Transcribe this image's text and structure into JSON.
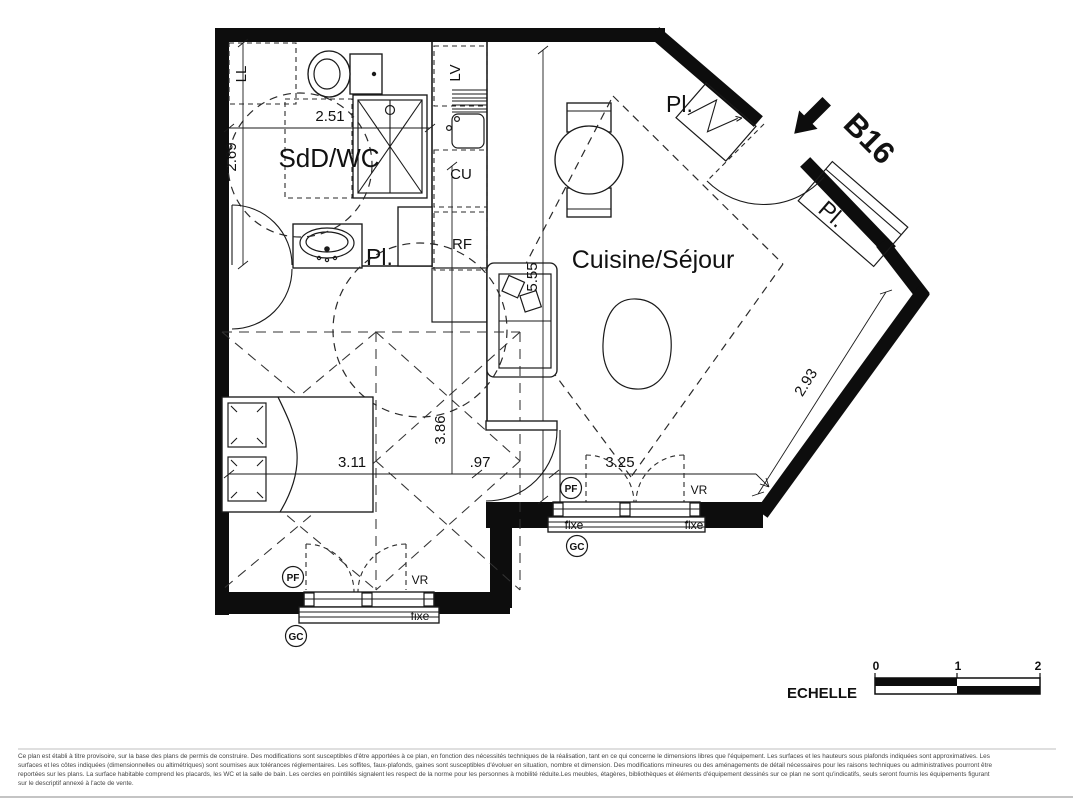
{
  "unit": {
    "label": "B16"
  },
  "rooms": {
    "bathroom": "SdD/WC",
    "living": "Cuisine/Séjour"
  },
  "closets": {
    "laundry": "LL",
    "placard": "Pl."
  },
  "kitchen": {
    "dishwasher": "LV",
    "cooking": "CU",
    "fridge": "RF"
  },
  "dimensions": {
    "bathroom_width": "2.51",
    "bathroom_depth": "2.69",
    "bedroom_width": "3.11",
    "passage": ".97",
    "room_depth": "3.86",
    "window_width": "3.25",
    "living_length": "5.55",
    "living_diagonal": "2.93"
  },
  "windows": {
    "pf": "PF",
    "vr": "VR",
    "fixe": "fixe",
    "gc": "GC"
  },
  "scale": {
    "label": "ECHELLE",
    "tick0": "0",
    "tick1": "1",
    "tick2": "2"
  },
  "footer": {
    "line1": "Ce plan est établi à titre provisoire, sur la base des plans de permis de construire. Des modifications sont susceptibles d'être apportées à ce plan, en fonction des nécessités techniques de la réalisation, tant en ce qui concerne le dimensions libres que l'équipement. Les surfaces et les hauteurs sous plafonds indiquées sont approximatives. Les",
    "line2": "surfaces et les côtes indiquées (dimensionnelles ou altimétriques) sont soumises aux tolérances réglementaires. Les soffites, faux-plafonds, gaines sont susceptibles d'évoluer en situation, nombre et dimension. Des modifications mineures ou des aménagements de détail nécessaires pour les raisons techniques ou administratives pourront être",
    "line3": "reportées sur les plans. La surface habitable comprend les placards, les WC et la salle de bain. Les cercles en pointillés signalent les respect de la norme pour les personnes à mobilité réduite.Les meubles, étagères, bibliothèques et éléments d'équipement dessinés sur ce plan ne sont qu'indicatifs, seuls seront fournis les équipements figurant",
    "line4": "sur le descriptif annexé à l'acte de vente."
  }
}
